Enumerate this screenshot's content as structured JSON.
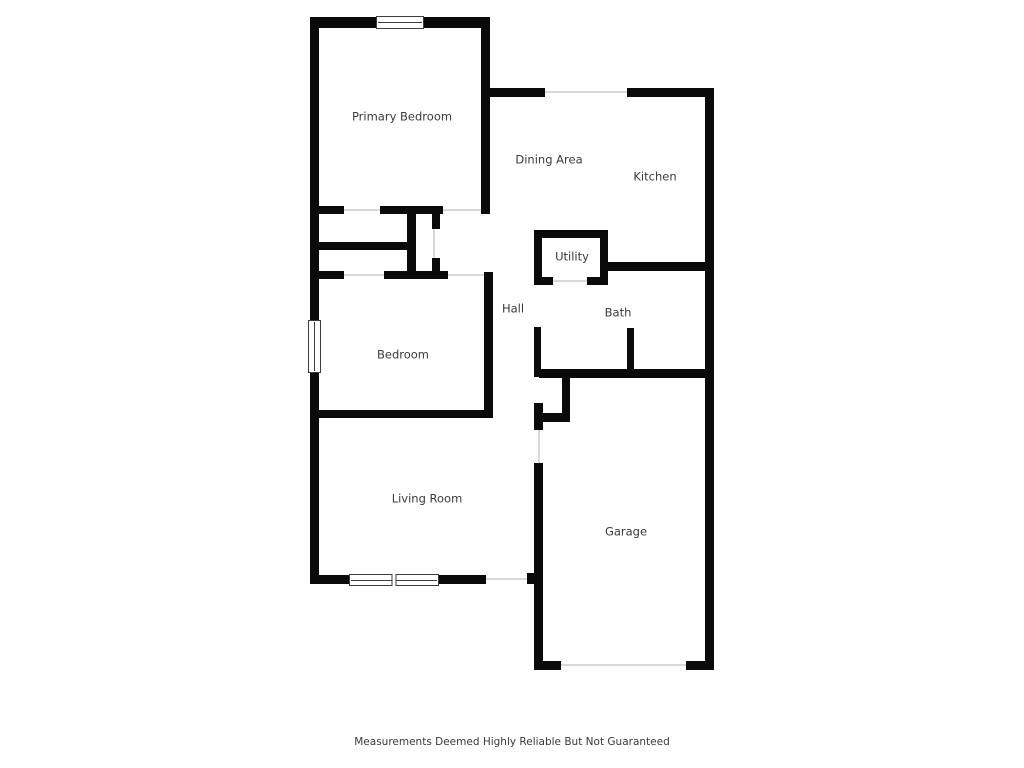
{
  "palette": {
    "wall_color": "#0a0a0a",
    "label_color": "#3a3a3a",
    "opening_line_color": "#d9d9d9",
    "window_line_color": "#3d3d3d",
    "background_color": "#ffffff"
  },
  "disclaimer": {
    "text": "Measurements Deemed Highly Reliable But Not Guaranteed"
  },
  "floorplan": {
    "rooms": [
      {
        "id": "primary-bedroom",
        "label": "Primary Bedroom",
        "cx": 402,
        "cy": 117
      },
      {
        "id": "dining-area",
        "label": "Dining Area",
        "cx": 549,
        "cy": 160
      },
      {
        "id": "kitchen",
        "label": "Kitchen",
        "cx": 655,
        "cy": 177
      },
      {
        "id": "utility",
        "label": "Utility",
        "cx": 572,
        "cy": 257
      },
      {
        "id": "hall",
        "label": "Hall",
        "cx": 513,
        "cy": 309
      },
      {
        "id": "bath",
        "label": "Bath",
        "cx": 618,
        "cy": 313
      },
      {
        "id": "bedroom",
        "label": "Bedroom",
        "cx": 403,
        "cy": 355
      },
      {
        "id": "living-room",
        "label": "Living Room",
        "cx": 427,
        "cy": 499
      },
      {
        "id": "garage",
        "label": "Garage",
        "cx": 626,
        "cy": 532
      }
    ],
    "walls": [
      [
        310,
        17,
        180,
        11
      ],
      [
        310,
        17,
        9,
        567
      ],
      [
        481,
        17,
        9,
        197
      ],
      [
        481,
        88,
        64,
        9
      ],
      [
        627,
        88,
        87,
        9
      ],
      [
        705,
        88,
        9,
        582
      ],
      [
        310,
        575,
        176,
        9
      ],
      [
        527,
        573,
        15,
        11
      ],
      [
        534,
        463,
        9,
        207
      ],
      [
        534,
        661,
        27,
        9
      ],
      [
        686,
        661,
        28,
        9
      ],
      [
        310,
        206,
        34,
        8
      ],
      [
        380,
        206,
        63,
        8
      ],
      [
        407,
        206,
        9,
        72
      ],
      [
        432,
        213,
        8,
        16
      ],
      [
        318,
        242,
        90,
        8
      ],
      [
        432,
        258,
        8,
        21
      ],
      [
        310,
        271,
        34,
        8
      ],
      [
        384,
        271,
        64,
        8
      ],
      [
        484,
        272,
        9,
        146
      ],
      [
        310,
        410,
        183,
        8
      ],
      [
        534,
        230,
        74,
        8
      ],
      [
        534,
        230,
        8,
        55
      ],
      [
        600,
        230,
        8,
        55
      ],
      [
        534,
        277,
        19,
        8
      ],
      [
        587,
        277,
        21,
        8
      ],
      [
        600,
        262,
        114,
        9
      ],
      [
        534,
        327,
        7,
        50
      ],
      [
        539,
        369,
        175,
        9
      ],
      [
        627,
        328,
        7,
        46
      ],
      [
        562,
        373,
        8,
        49
      ],
      [
        534,
        413,
        36,
        9
      ],
      [
        534,
        403,
        9,
        27
      ]
    ],
    "openings": [
      [
        545,
        91,
        82,
        2
      ],
      [
        443,
        209,
        38,
        2
      ],
      [
        344,
        209,
        36,
        2
      ],
      [
        433,
        229,
        2,
        29
      ],
      [
        344,
        274,
        40,
        2
      ],
      [
        448,
        274,
        36,
        2
      ],
      [
        553,
        280,
        34,
        2
      ],
      [
        538,
        430,
        2,
        33
      ],
      [
        486,
        578,
        41,
        2
      ],
      [
        561,
        664,
        125,
        2
      ]
    ],
    "windows": [
      {
        "x": 376,
        "y": 16,
        "w": 48,
        "h": 13,
        "orientation": "h",
        "panes": 1
      },
      {
        "x": 308,
        "y": 320,
        "w": 13,
        "h": 53,
        "orientation": "v",
        "panes": 1
      },
      {
        "x": 349,
        "y": 574,
        "w": 90,
        "h": 12,
        "orientation": "h",
        "panes": 2
      }
    ]
  }
}
